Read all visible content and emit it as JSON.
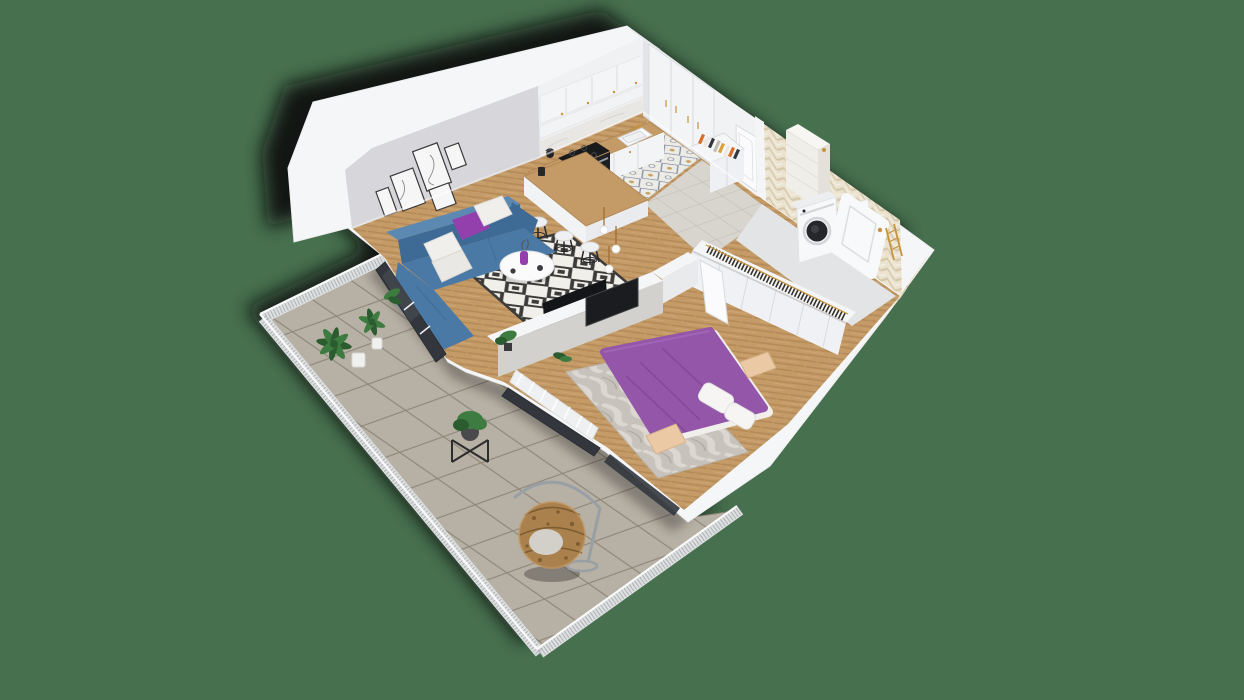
{
  "scene": {
    "type": "3d-isometric-apartment-floor-plan-render",
    "background_color": "#47704f",
    "rooms": [
      {
        "name": "living-room",
        "items": [
          "corner-sofa-blue",
          "purple-pillow",
          "white-pillows",
          "diamond-pattern-rug",
          "round-coffee-table",
          "purple-vase",
          "gallery-wall-frames",
          "tv-partition-wall",
          "balcony-sliding-door",
          "pendant-lights"
        ]
      },
      {
        "name": "kitchen",
        "items": [
          "upper-cabinets",
          "marble-backsplash",
          "counter-with-sink",
          "gold-faucet",
          "cooktop",
          "oven",
          "kettle",
          "tall-cabinets",
          "island-bar",
          "bar-stools",
          "ornamental-tile-floor"
        ]
      },
      {
        "name": "entry-hall",
        "items": [
          "entrance-door",
          "sideboard-with-books",
          "gray-tile-floor"
        ]
      },
      {
        "name": "bedroom",
        "items": [
          "double-bed-purple",
          "white-pillows",
          "nightstands",
          "wardrobe-with-hanging-clothes",
          "bedroom-tv",
          "marble-rug",
          "window-radiator",
          "open-door"
        ]
      },
      {
        "name": "bathroom",
        "items": [
          "washing-machine",
          "toilet",
          "bathtub",
          "shower-column",
          "gold-towel-ladder",
          "herringbone-tile-walls"
        ]
      },
      {
        "name": "balcony",
        "items": [
          "large-tile-floor",
          "mesh-railing",
          "potted-palms",
          "plant-stand",
          "hanging-egg-chair",
          "storage-crate"
        ]
      }
    ]
  },
  "colors": {
    "background": "#47704f",
    "shadow": "#0a0a0a",
    "wall_white": "#f5f6f8",
    "wall_edge": "#e3e4e8",
    "wall_gray": "#d7d7db",
    "wall_gray_dark": "#c9c9ce",
    "wood": "#c49a66",
    "wood_dark": "#ad8350",
    "wood_light": "#d9b586",
    "kitchen_tile_bg": "#edece4",
    "kitchen_tile_blue": "#7f89a8",
    "kitchen_tile_gold": "#c49a5a",
    "entry_tile": "#d8d5ce",
    "entry_grout": "#c2bfb7",
    "balcony_tile": "#b3ab9e",
    "balcony_grout": "#8b8578",
    "mesh": "#dddfe0",
    "mesh_dot": "#a3a7aa",
    "rug_bg": "#f1efe9",
    "rug_dark": "#3d3c3a",
    "marble_light": "#dcd8d1",
    "marble_base": "#c7c3bc",
    "sofa": "#4b79a6",
    "sofa_dark": "#3e6b96",
    "sofa_light": "#5c89b2",
    "pillow_purple": "#9340ac",
    "bed_purple": "#9356a9",
    "bed_purple_dark": "#7e4394",
    "textile_white": "#f0efec",
    "nightstand": "#eac9a4",
    "appliance_dark": "#232428",
    "glass": "#33373d",
    "gold": "#c6943c",
    "cord_brown": "#9c6a2e",
    "plant": "#3e7b40",
    "plant_dark": "#2b5c2f",
    "rattan": "#aa814d",
    "rattan_dark": "#6f5128",
    "beige_tile": "#ebe3d0",
    "beige_tile_line": "#d5c8ab",
    "door_white": "#fbfbfd",
    "seam": "#d9dadd",
    "book1": "#d96d2a",
    "book2": "#33363c",
    "book3": "#c2bcb2",
    "book4": "#d9a13b",
    "book5": "#efe9df"
  }
}
